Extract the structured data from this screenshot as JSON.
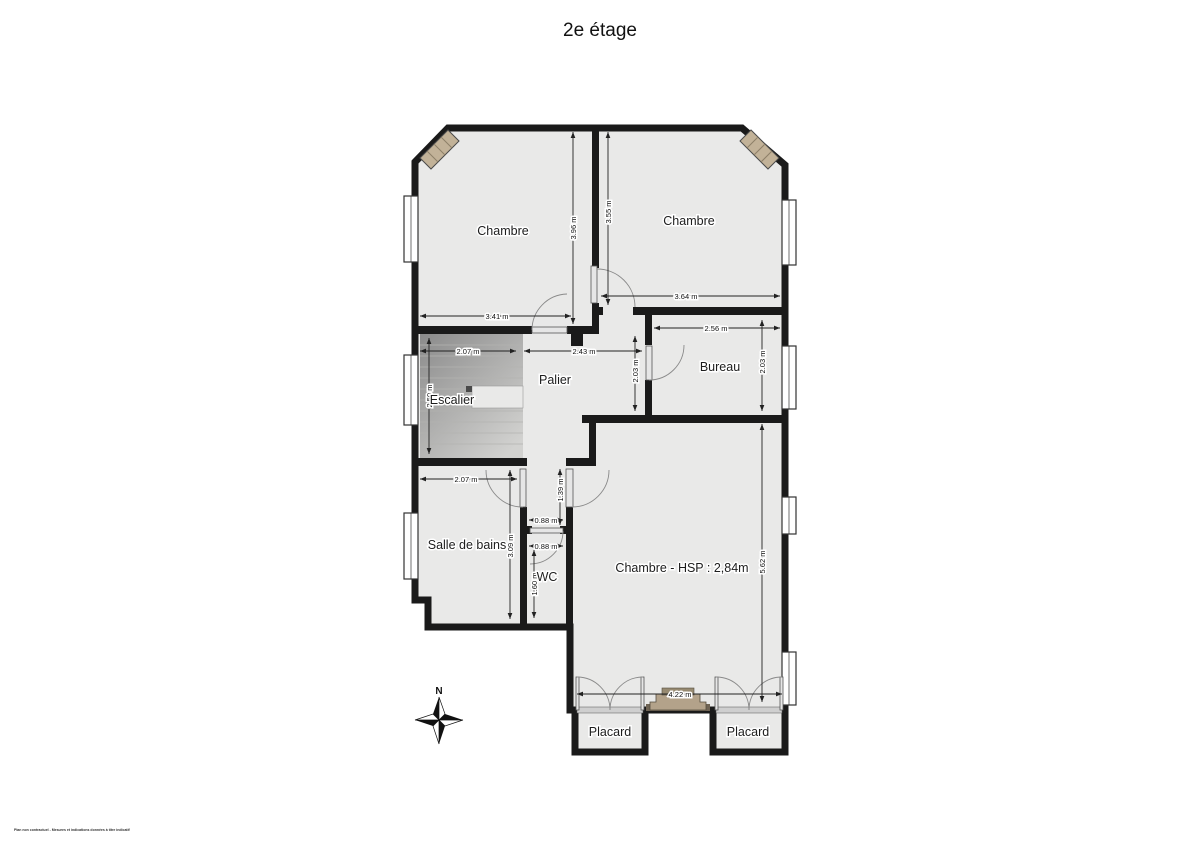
{
  "title": "2e étage",
  "compass": {
    "label": "N"
  },
  "footer": {
    "disclaimer": "Plan non contractuel - Mesures et indications données à titre indicatif"
  },
  "colors": {
    "wall": "#1a1a1a",
    "room_fill": "#e9e9e8",
    "stair_dark": "#8b8b8b",
    "chimney_tan": "#c2b298",
    "fireplace_tan": "#b3a28a",
    "dim_line": "#222222"
  },
  "plan": {
    "floor": "2e étage",
    "rooms": [
      {
        "label": "Chambre",
        "x": 503,
        "y": 231
      },
      {
        "label": "Chambre",
        "x": 689,
        "y": 221
      },
      {
        "label": "Bureau",
        "x": 720,
        "y": 367
      },
      {
        "label": "Palier",
        "x": 555,
        "y": 380
      },
      {
        "label": "Escalier",
        "x": 452,
        "y": 400
      },
      {
        "label": "Salle de bains",
        "x": 467,
        "y": 545
      },
      {
        "label": "WC",
        "x": 547,
        "y": 577
      },
      {
        "label": "Chambre - HSP : 2,84m",
        "x": 682,
        "y": 568
      },
      {
        "label": "Placard",
        "x": 610,
        "y": 732
      },
      {
        "label": "Placard",
        "x": 748,
        "y": 732
      }
    ],
    "dimensions": [
      {
        "label": "3.41 m",
        "orient": "h"
      },
      {
        "label": "3.96 m",
        "orient": "v"
      },
      {
        "label": "3.55 m",
        "orient": "v"
      },
      {
        "label": "3.64 m",
        "orient": "h"
      },
      {
        "label": "2.56 m",
        "orient": "h"
      },
      {
        "label": "2.03 m",
        "orient": "v"
      },
      {
        "label": "2.03 m",
        "orient": "v"
      },
      {
        "label": "2.07 m",
        "orient": "h"
      },
      {
        "label": "2.43 m",
        "orient": "h"
      },
      {
        "label": "2.50 m",
        "orient": "v"
      },
      {
        "label": "2.07 m",
        "orient": "h"
      },
      {
        "label": "3.09 m",
        "orient": "v"
      },
      {
        "label": "1.39 m",
        "orient": "v"
      },
      {
        "label": "0.88 m",
        "orient": "h"
      },
      {
        "label": "0.88 m",
        "orient": "h"
      },
      {
        "label": "1.60 m",
        "orient": "v"
      },
      {
        "label": "5.62 m",
        "orient": "v"
      },
      {
        "label": "4.22 m",
        "orient": "h"
      }
    ]
  }
}
